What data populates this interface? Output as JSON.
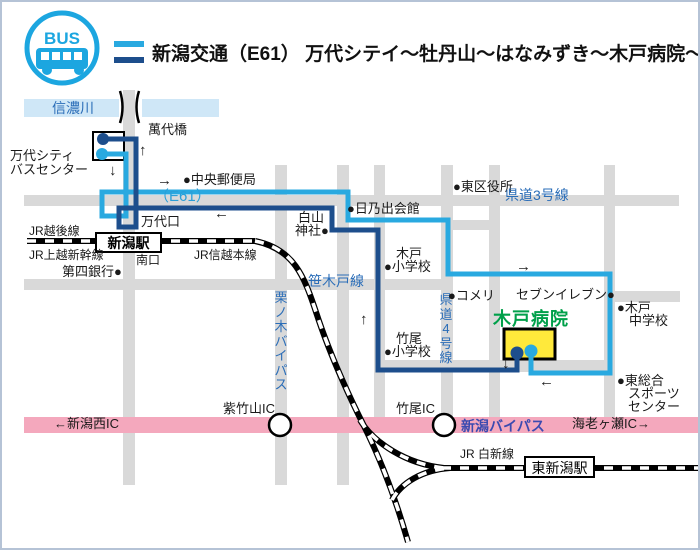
{
  "title_bar": {
    "logo": "BUS",
    "title": "新潟交通（E61） 万代シテイ～牡丹山～はなみずき～木戸病院～竹尾線"
  },
  "map": {
    "labels": {
      "shinano_river": "信濃川",
      "bandai_bridge": "萬代橋",
      "bus_center_line1": "万代シティ",
      "bus_center_line2": "バスセンター",
      "chuo_post_office": "●中央郵便局",
      "e61": "（E61）",
      "bandaiguchi": "万代口",
      "jr_echigo_line": "JR越後線",
      "niigata_station": "新潟駅",
      "jr_joetsu_shinkansen": "JR上越新幹線",
      "minamiguchi": "南口",
      "jr_shinetsu_line": "JR信越本線",
      "daishi_bank": "第四銀行●",
      "hakusan_line1": "白山",
      "hakusan_line2": "神社●",
      "hinode_hall": "●日乃出会館",
      "higashi_ward_office": "●東区役所",
      "kendo3": "県道3号線",
      "sasakido_line": "笹木戸線",
      "kurinoki_bypass": "栗ノ木バイパス",
      "kendo4": "県道4号線",
      "kido_elem_line1": "木戸",
      "kido_elem_line2": "●小学校",
      "takeo_elem_line1": "竹尾",
      "takeo_elem_line2": "●小学校",
      "komeri": "●コメリ",
      "seven_eleven": "セブンイレブン●",
      "kido_jhs_line1": "●木戸",
      "kido_jhs_line2": "中学校",
      "kido_hospital": "木戸病院",
      "sports_line1": "●東総合",
      "sports_line2": "スポーツ",
      "sports_line3": "センター",
      "shichikuyama_ic": "紫竹山IC",
      "takeo_ic": "竹尾IC",
      "niigata_west_ic": "←新潟西IC",
      "niigata_bypass": "新潟バイパス",
      "ebigase_ic": "海老ヶ瀬IC→",
      "jr_hakushin_line": "JR 白新線",
      "higashi_niigata_station": "東新潟駅"
    },
    "arrows": {
      "up": "↑",
      "down": "↓",
      "left": "←",
      "right": "→"
    },
    "colors": {
      "route_outbound_lightblue": "#29a9e0",
      "route_return_darkblue": "#1d4e8c",
      "road_gray": "#d9d9d9",
      "river_lightblue": "#cfe7f7",
      "bypass_pink": "#f4a8bd",
      "hospital_yellow": "#ffe93b",
      "hospital_green": "#00a04a",
      "road_label_blue": "#2a6db8",
      "bypass_label_indigo": "#3b4ab0",
      "logo_blue": "#1ca6e0"
    }
  }
}
